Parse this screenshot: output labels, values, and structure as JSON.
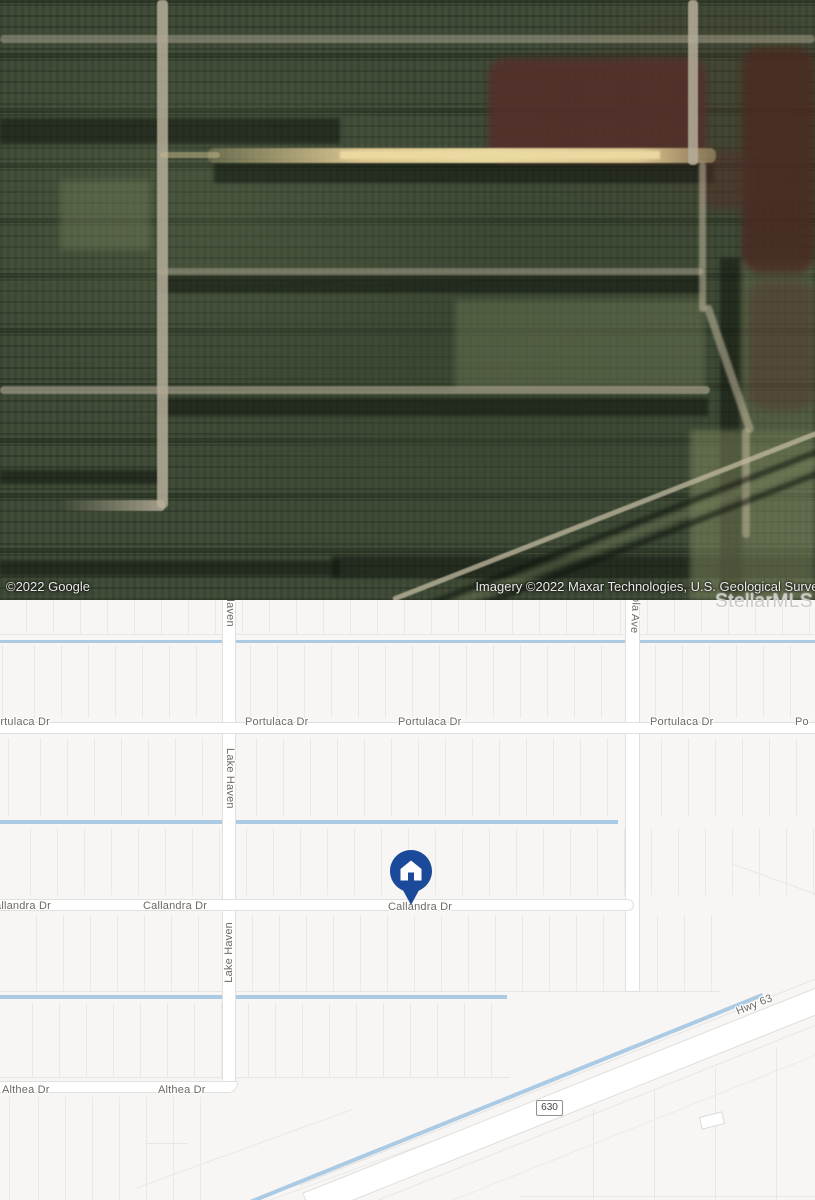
{
  "satellite": {
    "attribution_google": "©2022 Google",
    "attribution_imagery": "Imagery ©2022 Maxar Technologies, U.S. Geological Survey",
    "watermark": "StellarMLS"
  },
  "map": {
    "streets": {
      "portulaca": "Portulaca Dr",
      "portulaca_cut_left": "ortulaca Dr",
      "portulaca_cut_right": "Po",
      "callandra": "Callandra Dr",
      "callandra_cut_left": "allandra Dr",
      "althea": "Althea Dr",
      "lake_haven": "Lake Haven",
      "haven_cut": "Haven",
      "ola_ave": "ola Ave",
      "hwy_63": "Hwy 63"
    },
    "route_shield": "630",
    "marker": {
      "label": "property home pin"
    },
    "colors": {
      "background": "#f7f6f4",
      "road_fill": "#ffffff",
      "road_casing": "#e2e0dc",
      "parcel_line": "#ebe9e6",
      "water": "#abcbe5",
      "label_text": "#6d6a63",
      "pin_blue": "#1b4a9b"
    }
  }
}
